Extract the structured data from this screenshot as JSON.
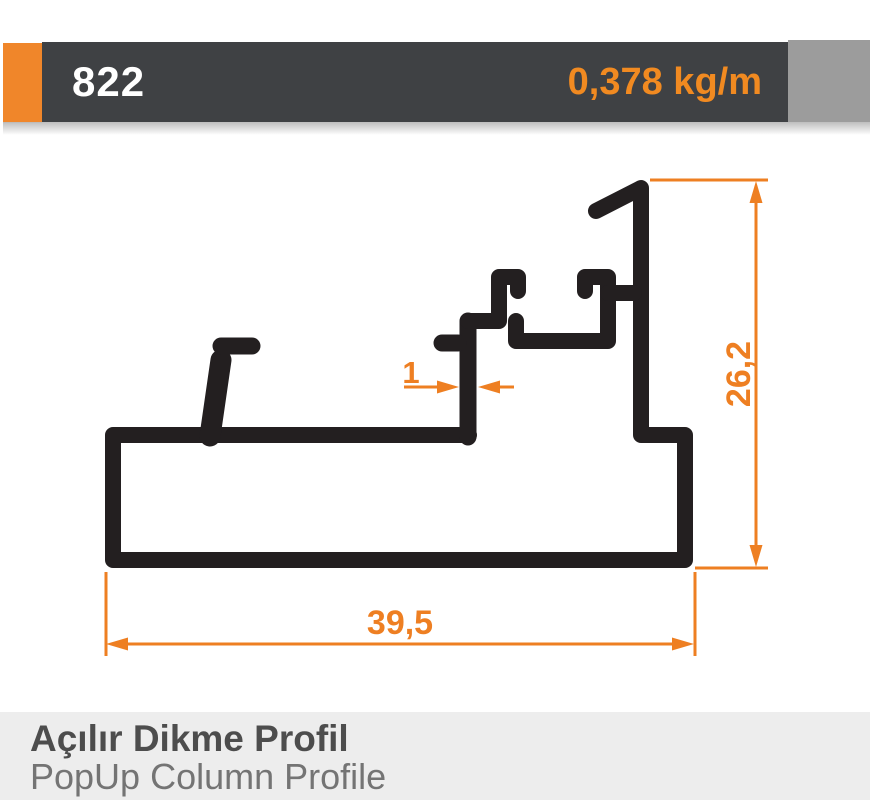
{
  "header": {
    "profile_number": "822",
    "weight": "0,378 kg/m"
  },
  "drawing": {
    "dim_width": "39,5",
    "dim_height": "26,2",
    "dim_wall": "1"
  },
  "footer": {
    "title_tr": "Açılır Dikme Profil",
    "title_en": "PopUp Column Profile"
  },
  "colors": {
    "accent_orange": "#ee7f22",
    "header_orange_block": "#f0862a",
    "header_dark_bar": "#3f4144",
    "header_gray_block": "#9c9c9c",
    "profile_black": "#231f20",
    "footer_background": "#ededed"
  }
}
